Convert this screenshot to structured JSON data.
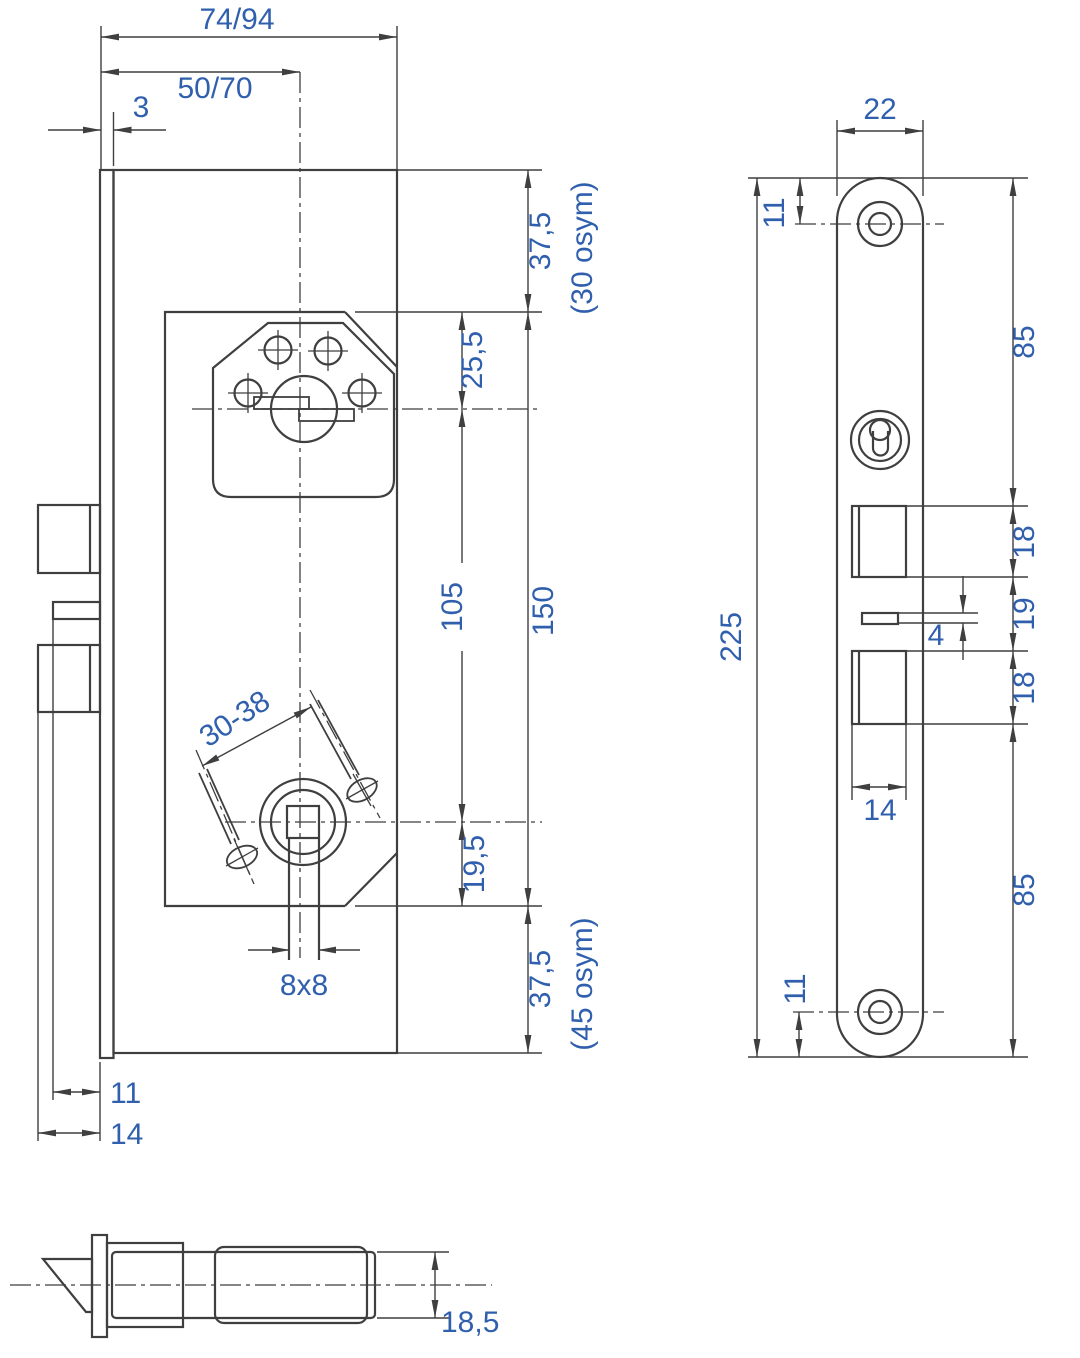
{
  "drawing": {
    "type": "mortise-lock-dimension-drawing",
    "colors": {
      "line": "#3f3f3f",
      "dimension_text": "#3060ad"
    },
    "side_view": {
      "overall_depth": "74/94",
      "backset": "50/70",
      "faceplate_thickness": "3",
      "case_top_offset": "37,5",
      "case_top_note": "(30 osym)",
      "cylinder_offset": "25,5",
      "cylinder_to_spindle": "105",
      "inner_height": "150",
      "spindle_bottom_offset": "19,5",
      "case_bottom_offset": "37,5",
      "case_bottom_note": "(45 osym)",
      "handle_screw_span": "30-38",
      "spindle_square": "8x8",
      "aux_bolt_throw": "11",
      "deadbolt_throw": "14"
    },
    "front_view": {
      "plate_width": "22",
      "top_screw_offset": "11",
      "plate_length": "225",
      "top_to_latch": "85",
      "latch_opening": "18",
      "opening_gap": "19",
      "bolt_opening": "18",
      "aux_bolt_thickness": "4",
      "opening_width": "14",
      "bolt_to_bottom": "85",
      "bottom_screw_offset": "11"
    },
    "latch_view": {
      "latch_width": "18,5"
    }
  }
}
